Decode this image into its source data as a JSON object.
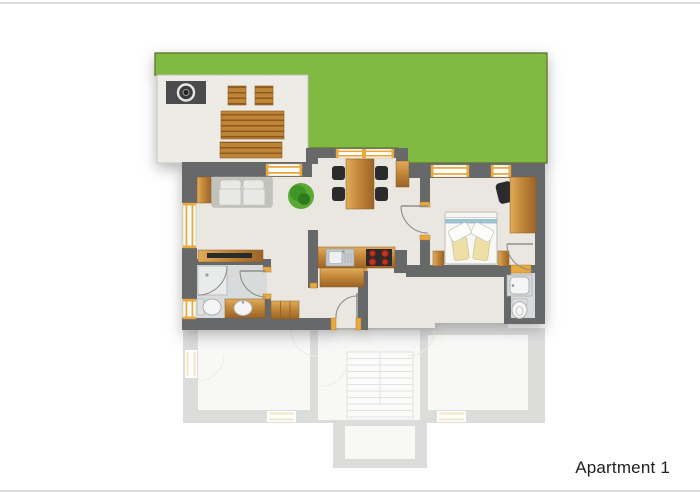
{
  "label": {
    "text": "Apartment 1"
  },
  "colors": {
    "page_bg": "#ffffff",
    "hairline": "#dedede",
    "label_color": "#212121",
    "grass": "#7cb83c",
    "grass_edge": "#55661f",
    "wall": "#67686a",
    "floor": "#eae7e1",
    "floor_bath": "#d9dadc",
    "terrace": "#edebe5",
    "window_accent": "#eaa93f",
    "chair_black": "#2b2b2b",
    "stove_burner": "#c23222",
    "plant_green": "#46a02a",
    "fixture_white": "#f4f5f4"
  },
  "floorplan": {
    "unit_label": "Apartment 1",
    "features": [
      "garden-lawn",
      "terrace",
      "grill",
      "garden-table",
      "garden-bench",
      "garden-stools",
      "sofa",
      "side-table",
      "tv-board",
      "plant",
      "dining-table",
      "dining-chairs",
      "sideboard",
      "kitchen-counter",
      "sink",
      "stove",
      "kitchen-cabinet",
      "shower",
      "toilet",
      "washbasin",
      "wardrobe",
      "double-bed",
      "nightstands",
      "desk",
      "desk-chair",
      "second-bathroom-washbasin",
      "second-bathroom-toilet",
      "lower-floor-outline",
      "staircase"
    ]
  }
}
